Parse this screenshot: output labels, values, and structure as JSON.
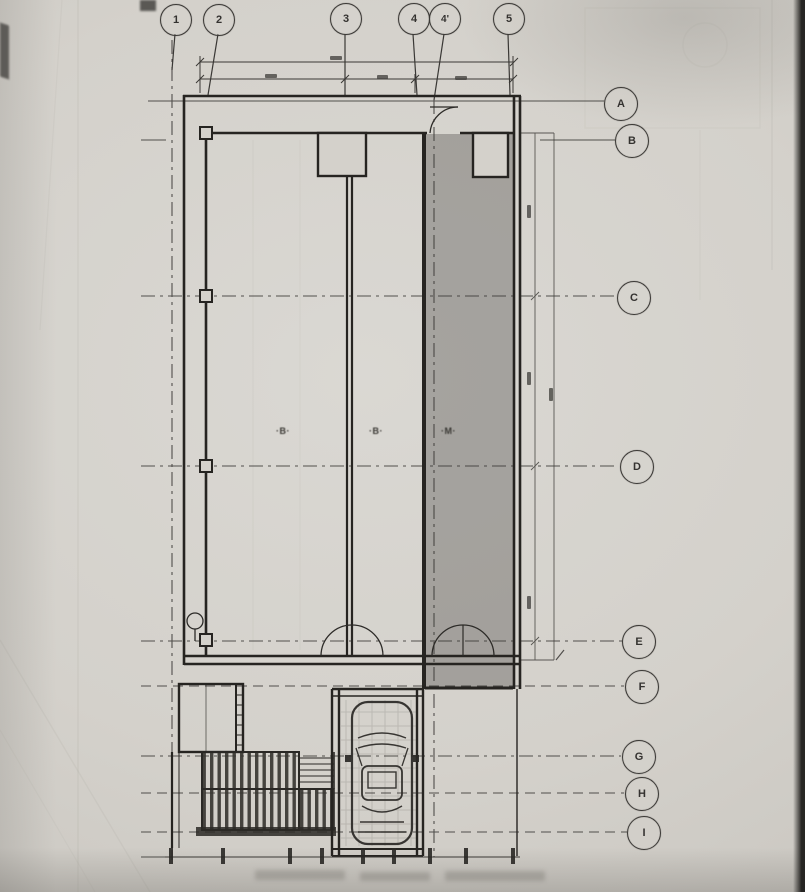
{
  "plan": {
    "top_axis_bubbles": [
      {
        "label": "1"
      },
      {
        "label": "2"
      },
      {
        "label": "3"
      },
      {
        "label": "4"
      },
      {
        "label": "4'"
      },
      {
        "label": "5"
      }
    ],
    "right_axis_bubbles": [
      {
        "label": "A"
      },
      {
        "label": "B"
      },
      {
        "label": "C"
      },
      {
        "label": "D"
      },
      {
        "label": "E"
      },
      {
        "label": "F"
      },
      {
        "label": "G"
      },
      {
        "label": "H"
      },
      {
        "label": "I"
      }
    ],
    "room_marks": [
      {
        "text": "·B·"
      },
      {
        "text": "·B·"
      },
      {
        "text": "·M·"
      }
    ],
    "colors": {
      "paper": "#d4d1cb",
      "ink": "#34322f",
      "wall": "#262421",
      "shaded_zone": "rgba(88,86,82,0.40)"
    }
  }
}
